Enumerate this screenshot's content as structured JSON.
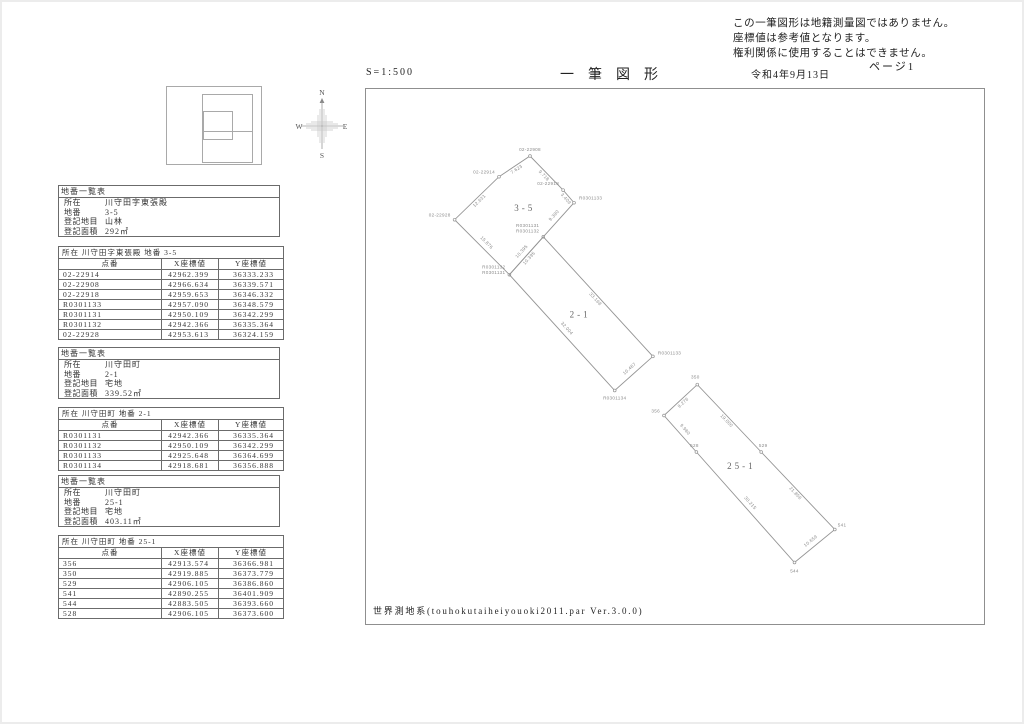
{
  "page": {
    "disclaimer_lines": [
      "この一筆図形は地籍測量図ではありません。",
      "座標値は参考値となります。",
      "権利関係に使用することはできません。"
    ],
    "scale": "S=1:500",
    "title": "一筆図形",
    "date": "令和4年9月13日",
    "page_no": "ページ1",
    "datum_note": "世界測地系(touhokutaiheiyouoki2011.par Ver.3.0.0)"
  },
  "compass": {
    "north": "N",
    "south": "S",
    "east": "E",
    "west": "W"
  },
  "sidebar": {
    "summary_title": "地番一覧表",
    "labels": {
      "location": "所在",
      "parcel": "地番",
      "category": "登記地目",
      "area": "登記面積"
    },
    "summaries": [
      {
        "location": "川守田字東張殿",
        "parcel": "3-5",
        "category": "山林",
        "area": "292㎡"
      },
      {
        "location": "川守田町",
        "parcel": "2-1",
        "category": "宅地",
        "area": "339.52㎡"
      },
      {
        "location": "川守田町",
        "parcel": "25-1",
        "category": "宅地",
        "area": "403.11㎡"
      }
    ],
    "coord_tables": [
      {
        "title": "所在 川守田字東張殿  地番 3-5",
        "columns": [
          "点番",
          "X座標値",
          "Y座標値"
        ],
        "rows": [
          [
            "02-22914",
            "42962.399",
            "36333.233"
          ],
          [
            "02-22908",
            "42966.634",
            "36339.571"
          ],
          [
            "02-22918",
            "42959.653",
            "36346.332"
          ],
          [
            "R0301133",
            "42957.090",
            "36348.579"
          ],
          [
            "R0301131",
            "42950.109",
            "36342.299"
          ],
          [
            "R0301132",
            "42942.366",
            "36335.364"
          ],
          [
            "02-22928",
            "42953.613",
            "36324.159"
          ]
        ]
      },
      {
        "title": "所在 川守田町  地番 2-1",
        "columns": [
          "点番",
          "X座標値",
          "Y座標値"
        ],
        "rows": [
          [
            "R0301131",
            "42942.366",
            "36335.364"
          ],
          [
            "R0301132",
            "42950.109",
            "36342.299"
          ],
          [
            "R0301133",
            "42925.648",
            "36364.699"
          ],
          [
            "R0301134",
            "42918.681",
            "36356.888"
          ]
        ]
      },
      {
        "title": "所在 川守田町  地番 25-1",
        "columns": [
          "点番",
          "X座標値",
          "Y座標値"
        ],
        "rows": [
          [
            "356",
            "42913.574",
            "36366.981"
          ],
          [
            "350",
            "42919.885",
            "36373.779"
          ],
          [
            "529",
            "42906.105",
            "36386.860"
          ],
          [
            "541",
            "42890.255",
            "36401.909"
          ],
          [
            "544",
            "42883.505",
            "36393.660"
          ],
          [
            "528",
            "42906.105",
            "36373.600"
          ]
        ]
      }
    ]
  },
  "map": {
    "parcels": [
      {
        "number": "3-5",
        "points": [
          {
            "names": [
              "02-22914"
            ],
            "x": 42962.399,
            "y": 36333.233,
            "anchor": "end",
            "offset": [
              -4,
              -3
            ]
          },
          {
            "names": [
              "02-22908"
            ],
            "x": 42966.634,
            "y": 36339.571,
            "anchor": "middle",
            "offset": [
              0,
              -5
            ]
          },
          {
            "names": [
              "02-22918"
            ],
            "x": 42959.653,
            "y": 36346.332,
            "anchor": "end",
            "offset": [
              -4,
              -5
            ]
          },
          {
            "names": [
              "R0301133"
            ],
            "x": 42957.09,
            "y": 36348.579,
            "anchor": "start",
            "offset": [
              5,
              -3
            ]
          },
          {
            "names": [
              "R0301131",
              "R0301132"
            ],
            "x": 42950.109,
            "y": 36342.299,
            "anchor": "end",
            "offset": [
              -4,
              -10
            ]
          },
          {
            "names": [
              "R0301132",
              "R0301131"
            ],
            "x": 42942.366,
            "y": 36335.364,
            "anchor": "end",
            "offset": [
              -4,
              -6
            ]
          },
          {
            "names": [
              "02-22928"
            ],
            "x": 42953.613,
            "y": 36324.159,
            "anchor": "end",
            "offset": [
              -4,
              -3
            ]
          }
        ],
        "edge_lengths": [
          "7.623",
          "9.718",
          "3.409",
          "9.390",
          "10.395",
          "15.876",
          "12.631"
        ]
      },
      {
        "number": "2-1",
        "points": [
          {
            "names": [],
            "marker": false,
            "x": 42942.366,
            "y": 36335.364,
            "anchor": "end",
            "offset": [
              0,
              0
            ]
          },
          {
            "names": [],
            "marker": false,
            "x": 42950.109,
            "y": 36342.299,
            "anchor": "end",
            "offset": [
              0,
              0
            ]
          },
          {
            "names": [
              "R0301133"
            ],
            "x": 42925.648,
            "y": 36364.699,
            "anchor": "start",
            "offset": [
              5,
              -2
            ]
          },
          {
            "names": [
              "R0301134"
            ],
            "x": 42918.681,
            "y": 36356.888,
            "anchor": "middle",
            "offset": [
              0,
              9
            ]
          }
        ],
        "edge_lengths": [
          "10.395",
          "33.168",
          "10.467",
          "32.004"
        ]
      },
      {
        "number": "25-1",
        "points": [
          {
            "names": [
              "356"
            ],
            "x": 42913.574,
            "y": 36366.981,
            "anchor": "end",
            "offset": [
              -4,
              -3
            ]
          },
          {
            "names": [
              "350"
            ],
            "x": 42919.885,
            "y": 36373.779,
            "anchor": "middle",
            "offset": [
              -2,
              -6
            ]
          },
          {
            "names": [
              "529"
            ],
            "x": 42906.105,
            "y": 36386.86,
            "anchor": "middle",
            "offset": [
              2,
              -5
            ]
          },
          {
            "names": [
              "541"
            ],
            "x": 42890.255,
            "y": 36401.909,
            "anchor": "start",
            "offset": [
              3,
              -3
            ]
          },
          {
            "names": [
              "544"
            ],
            "x": 42883.505,
            "y": 36393.66,
            "anchor": "middle",
            "offset": [
              0,
              10
            ]
          },
          {
            "names": [
              "528"
            ],
            "x": 42906.105,
            "y": 36373.6,
            "anchor": "middle",
            "offset": [
              -2,
              -5
            ]
          }
        ],
        "edge_lengths": [
          "9.276",
          "19.000",
          "21.856",
          "10.659",
          "30.215",
          "9.980"
        ]
      }
    ]
  },
  "colors": {
    "line": "#949494",
    "text": "#333333",
    "faint": "#8a8a8a"
  }
}
